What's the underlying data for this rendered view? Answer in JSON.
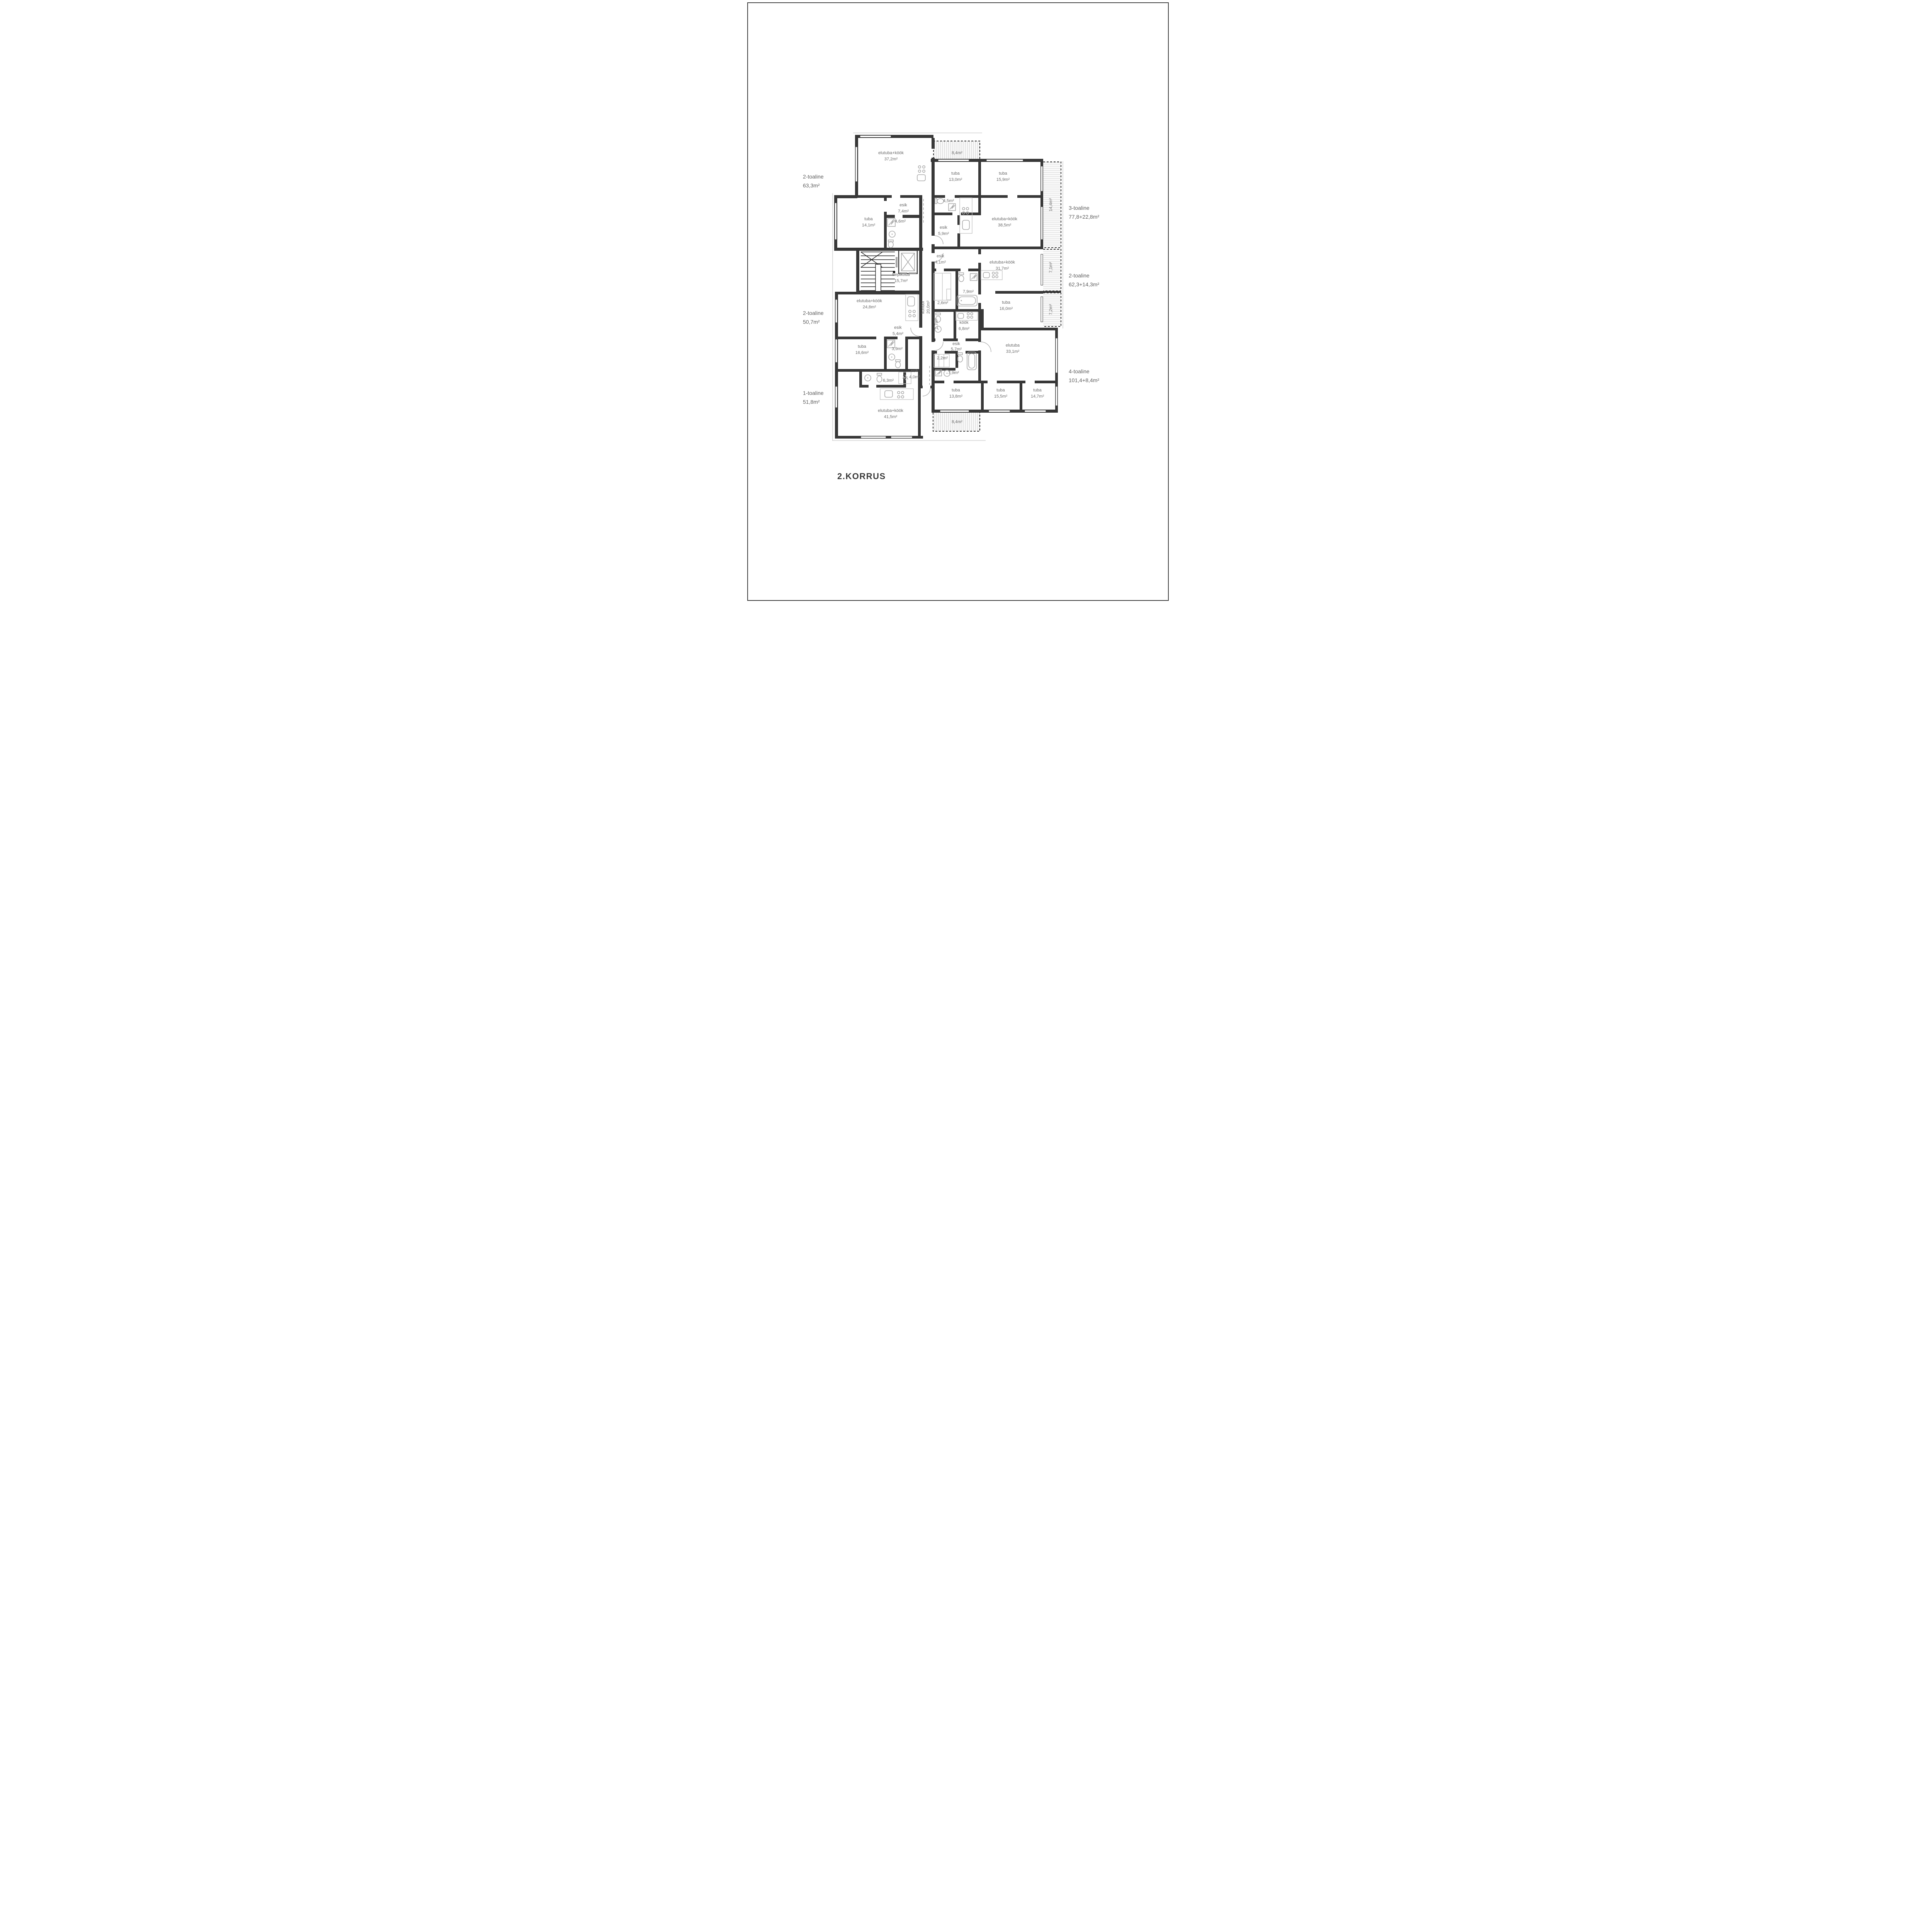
{
  "title": "2.KORRUS",
  "colors": {
    "wall": "#383838",
    "label": "#6a6a6a",
    "fixture": "#a8a8a8",
    "accent_dash": "#2e2e2e"
  },
  "apartments": {
    "left": [
      {
        "type": "2-toaline",
        "area": "63,3m²"
      },
      {
        "type": "2-toaline",
        "area": "50,7m²"
      },
      {
        "type": "1-toaline",
        "area": "51,8m²"
      }
    ],
    "right": [
      {
        "type": "3-toaline",
        "area": "77,8+22,8m²"
      },
      {
        "type": "2-toaline",
        "area": "62,3+14,3m²"
      },
      {
        "type": "4-toaline",
        "area": "101,4+8,4m²"
      }
    ]
  },
  "rooms": {
    "a_living": {
      "name": "elutuba+köök",
      "area": "37,2m²"
    },
    "top_balcony": {
      "area": "8,4m²"
    },
    "f_tuba1": {
      "name": "tuba",
      "area": "13,0m²"
    },
    "f_tuba2": {
      "name": "tuba",
      "area": "15,9m²"
    },
    "a_esik": {
      "name": "esik",
      "area": "7,4m²"
    },
    "f_bath": {
      "area": "4,5m²"
    },
    "a_bath": {
      "area": "4,6m²"
    },
    "a_tuba": {
      "name": "tuba",
      "area": "14,1m²"
    },
    "f_living": {
      "name": "elutuba+köök",
      "area": "38,5m²"
    },
    "f_esik": {
      "name": "esik",
      "area": "5,9m²"
    },
    "f_balcony": {
      "area": "14,4m²"
    },
    "g_esik": {
      "name": "esik",
      "area": "4,1m²"
    },
    "g_living": {
      "name": "elutuba+köök",
      "area": "31,7m²"
    },
    "g_balcony1": {
      "area": "7,1m²"
    },
    "stairwell": {
      "name": "trepikoda",
      "area": "15,7m²"
    },
    "corridor": {
      "name": "koridor",
      "area": "20,0m²"
    },
    "g_wc": {
      "area": "2,6m²"
    },
    "g_bath": {
      "area": "7,9m²"
    },
    "g_tuba": {
      "name": "tuba",
      "area": "16,0m²"
    },
    "g_balcony2": {
      "area": "7,2m²"
    },
    "c_living": {
      "name": "elutuba+köök",
      "area": "24,8m²"
    },
    "h_closet": {
      "area": "1,7m²"
    },
    "h_kitchen": {
      "name": "köök",
      "area": "6,8m²"
    },
    "c_esik": {
      "name": "esik",
      "area": "5,4m²"
    },
    "h_esik": {
      "name": "esik",
      "area": "5,7m²"
    },
    "h_living": {
      "name": "elutuba",
      "area": "33,1m²"
    },
    "c_tuba": {
      "name": "tuba",
      "area": "16,6m²"
    },
    "c_bath": {
      "area": "3,9m²"
    },
    "h_wc": {
      "area": "2,2m²"
    },
    "h_bath": {
      "area": "7,9m²"
    },
    "d_esik": {
      "name": "esik",
      "area": "4,0m²"
    },
    "d_bath": {
      "area": "6,3m²"
    },
    "h_tuba1": {
      "name": "tuba",
      "area": "13,8m²"
    },
    "h_tuba2": {
      "name": "tuba",
      "area": "15,5m²"
    },
    "h_tuba3": {
      "name": "tuba",
      "area": "14,7m²"
    },
    "d_living": {
      "name": "elutuba+köök",
      "area": "41,5m²"
    },
    "bottom_balcony": {
      "area": "8,4m²"
    }
  }
}
